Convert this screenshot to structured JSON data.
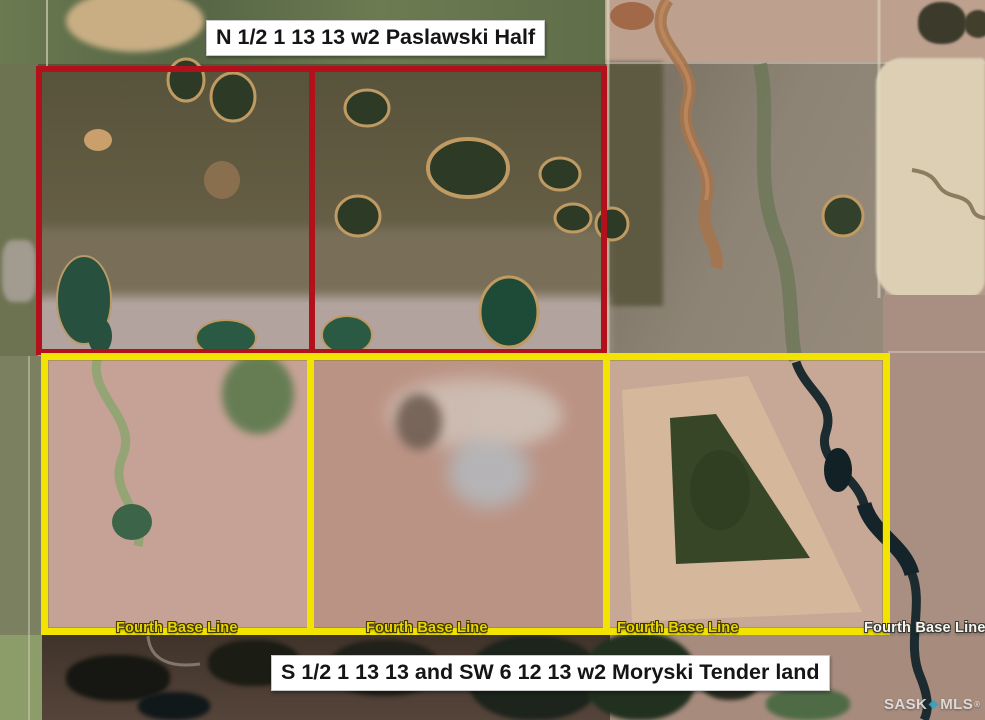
{
  "labels": {
    "north_title": "N 1/2 1 13 13 w2 Paslawski Half",
    "south_title": "S 1/2 1 13 13 and SW 6 12 13 w2 Moryski Tender land"
  },
  "road_labels": [
    "Fourth Base Line",
    "Fourth Base Line",
    "Fourth Base Line",
    "Fourth Base Line"
  ],
  "watermark": {
    "brand_left": "SASK",
    "brand_right": "MLS",
    "registered": "®"
  },
  "colors": {
    "north_boundary": "#b2101b",
    "south_boundary": "#f2e400",
    "road_label_yellow": "#e8d400",
    "road_label_white": "#f8f6f0",
    "label_background": "#ffffff",
    "watermark_diamond": "#35a3c0"
  }
}
